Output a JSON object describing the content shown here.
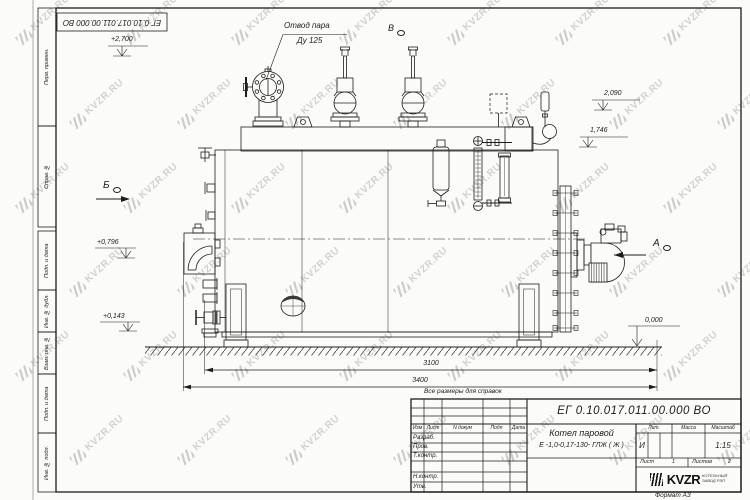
{
  "watermark": {
    "text": "KVZR.RU"
  },
  "corner_stamp": {
    "designation": "ЕГ 0.10.017.011.00.000  ВО"
  },
  "margin_labels": [
    "Перв. примен.",
    "Справ. №",
    "Подп. и дата",
    "Инв. № дубл.",
    "Взам. инв. №",
    "Подп. и дата",
    "Инв. № подл."
  ],
  "drawing": {
    "callout_line1": "Отвод пара",
    "callout_line2": "Ду 125",
    "view_top": "В",
    "view_left": "Б",
    "view_right": "А",
    "elevations": {
      "top": "+2,700",
      "e2090": "2,090",
      "e1746": "1,746",
      "e0796": "+0,796",
      "e0143": "+0,143",
      "zero": "0,000"
    },
    "dimensions": {
      "inner": "3100",
      "overall": "3400"
    }
  },
  "notes": {
    "reference": "Все размеры для справок"
  },
  "title_block": {
    "designation": "ЕГ 0.10.017.011.00.000  ВО",
    "name_line1": "Котел паровой",
    "name_line2": "Е -1,0-0,17-130- ГЛЖ ( Ж )",
    "header_cols": [
      "Изм",
      "Лист",
      "N докум",
      "Подп",
      "Дата"
    ],
    "sig_rows": [
      "Разраб.",
      "Пров.",
      "Т.контр.",
      "",
      "Н.контр.",
      "Утв."
    ],
    "lit_label": "Лит.",
    "mass_label": "Масса",
    "scale_label": "Масштаб",
    "lit_value": "И",
    "scale_value": "1:15",
    "sheet_label": "Лист",
    "sheet_number": "1",
    "sheets_label": "Листов",
    "sheets_total": "2",
    "logo_text": "KVZR",
    "logo_subtitle1": "КОТЕЛЬНЫЙ",
    "logo_subtitle2": "ЗАВОД РЭП",
    "format_note": "Формат А3"
  }
}
